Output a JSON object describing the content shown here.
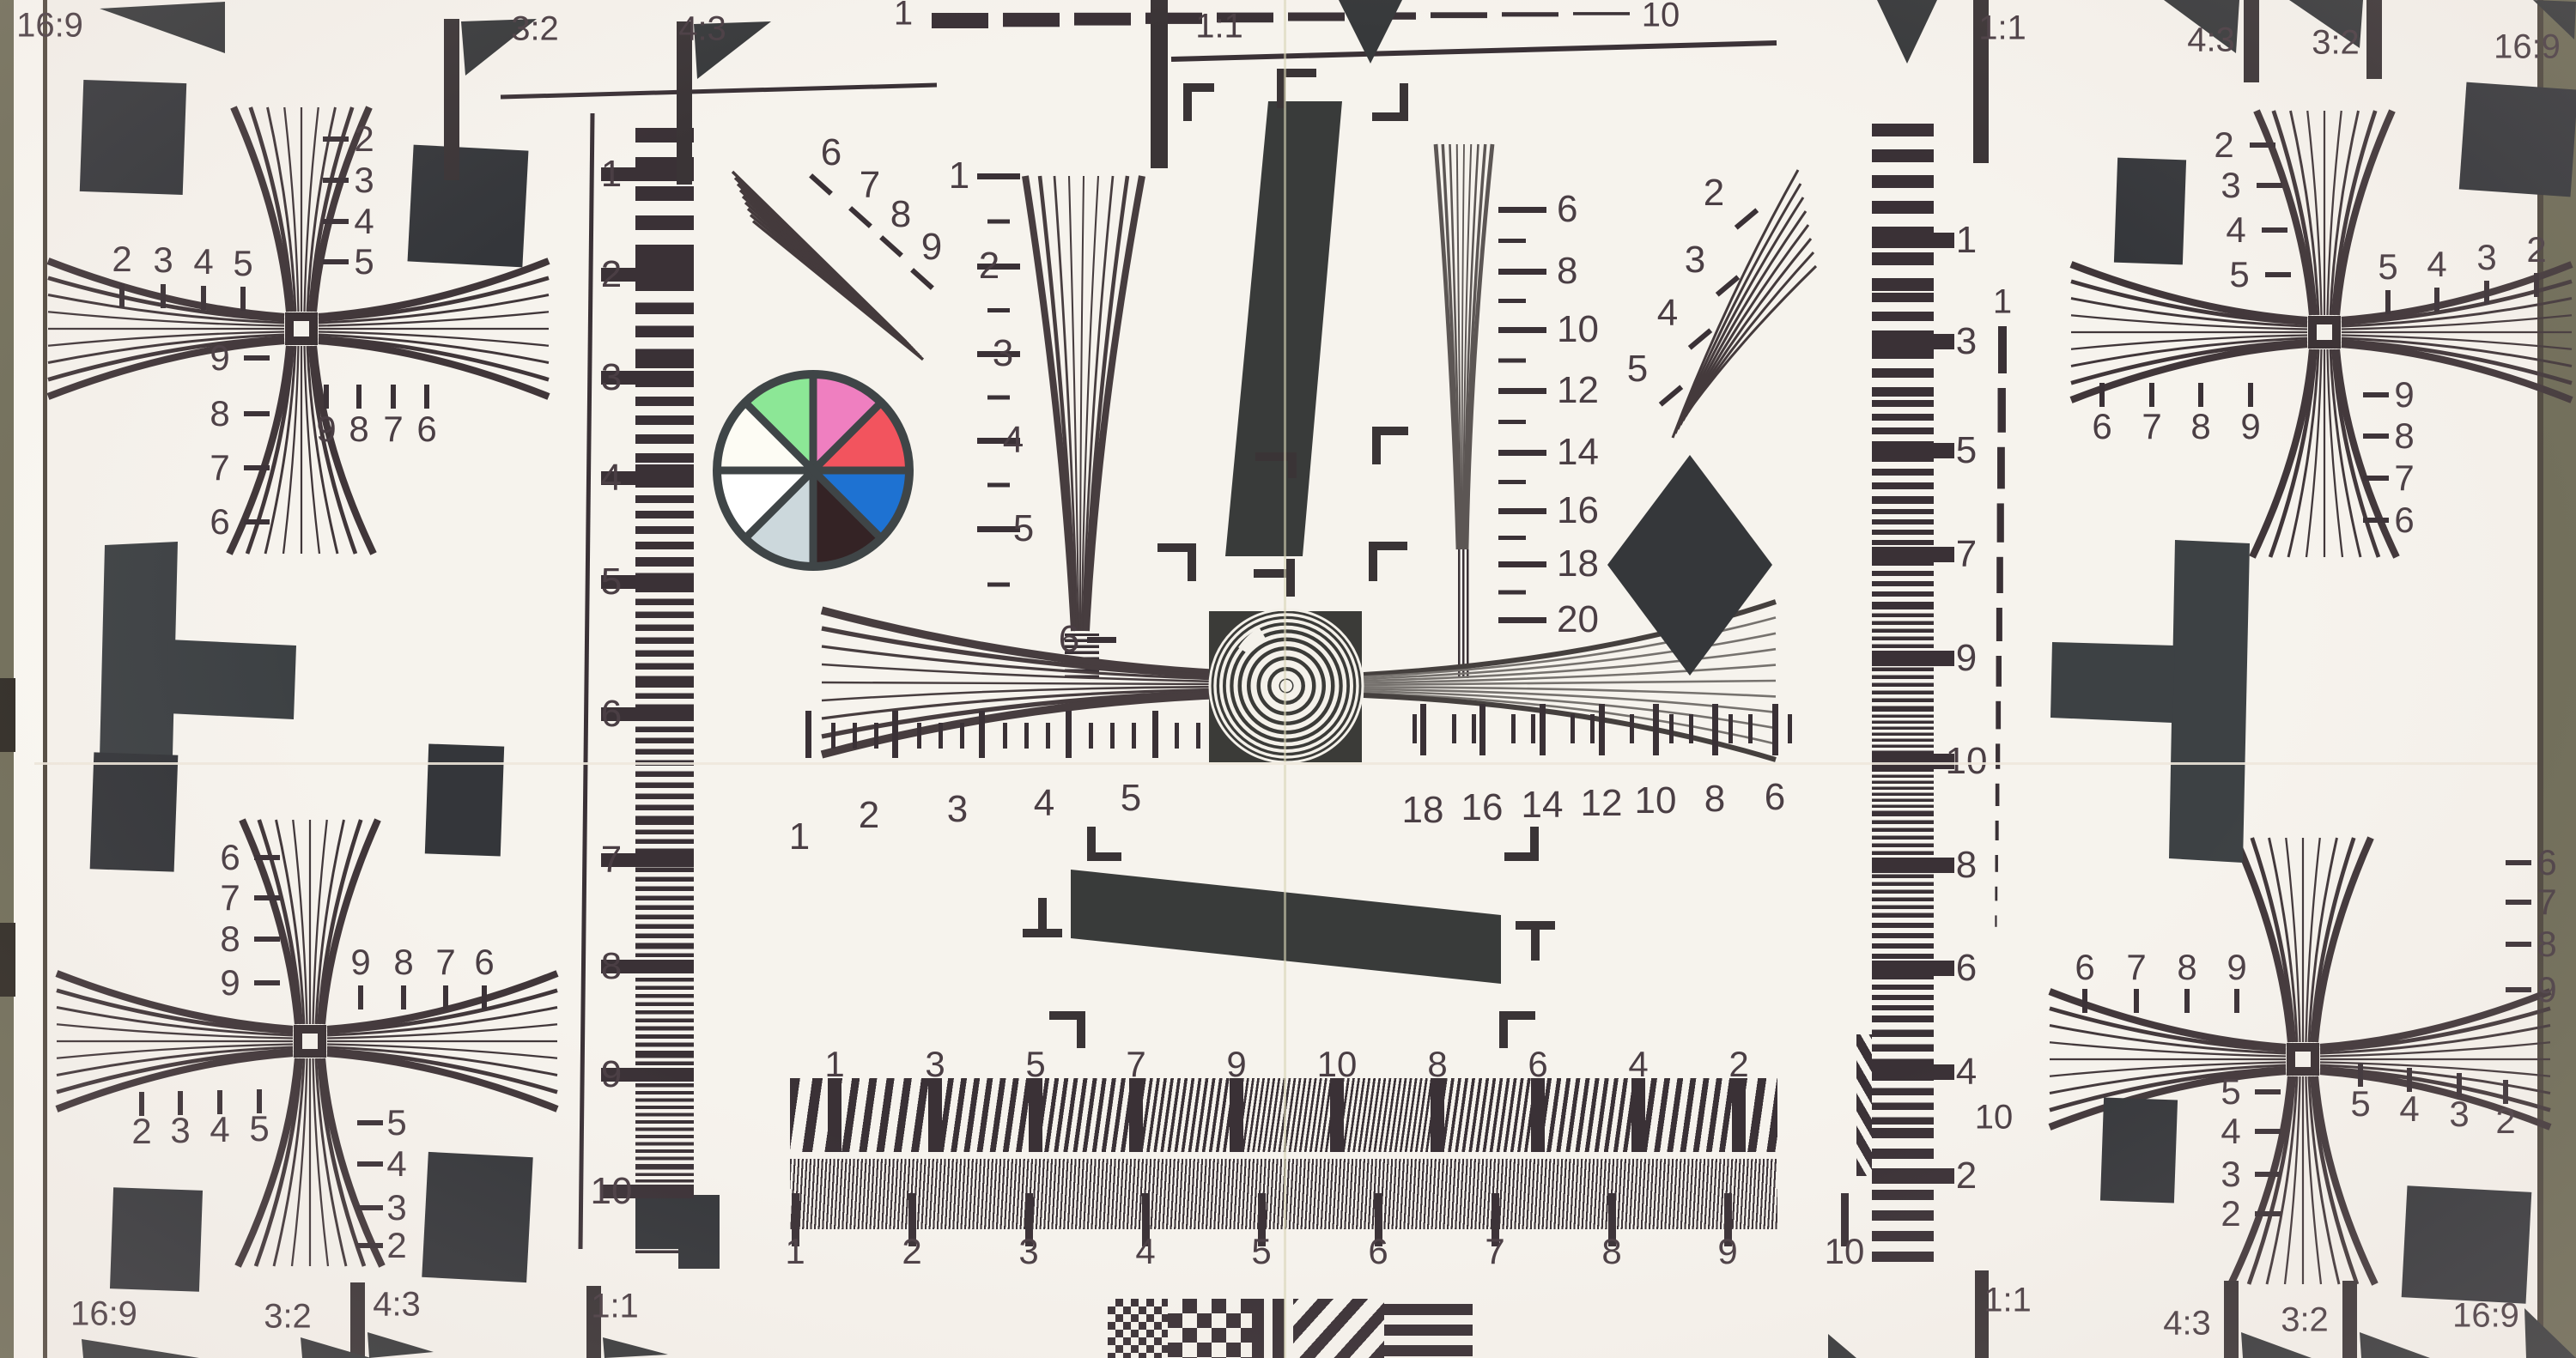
{
  "chart_title": "ISO 12233 resolution test chart (photograph)",
  "corner_labels": {
    "top": [
      "16:9",
      "3:2",
      "4:3",
      "1:1",
      "1:1",
      "4:3",
      "3:2",
      "16:9"
    ],
    "bottom": [
      "16:9",
      "3:2",
      "4:3",
      "1:1",
      "1:1",
      "4:3",
      "3:2",
      "16:9"
    ]
  },
  "top_ruler": {
    "start": "1",
    "end": "10"
  },
  "right_dashed_scale": {
    "top": "1",
    "bottom": "10"
  },
  "left_scale": [
    "1",
    "2",
    "3",
    "4",
    "5",
    "6",
    "7",
    "8",
    "9",
    "10"
  ],
  "inner_left_scale": [
    "1",
    "2",
    "3",
    "4",
    "5",
    "6"
  ],
  "inner_right_scale": [
    "6",
    "8",
    "10",
    "12",
    "14",
    "16",
    "18",
    "20"
  ],
  "diagonal_wedge_numbers": [
    "6",
    "7",
    "8",
    "9"
  ],
  "top_right_fan_numbers": [
    "2",
    "3",
    "4",
    "5"
  ],
  "center_ruler_left": [
    "1",
    "2",
    "3",
    "4",
    "5"
  ],
  "center_ruler_right": [
    "18",
    "16",
    "14",
    "12",
    "10",
    "8",
    "6"
  ],
  "bottom_wedge_numbers": [
    "1",
    "3",
    "5",
    "7",
    "9",
    "10",
    "8",
    "6",
    "4",
    "2"
  ],
  "bottom_ruler": [
    "1",
    "2",
    "3",
    "4",
    "5",
    "6",
    "7",
    "8",
    "9",
    "10"
  ],
  "right_strip_numbers": [
    "1",
    "3",
    "5",
    "7",
    "9",
    "10",
    "8",
    "6",
    "4",
    "2"
  ],
  "stars": {
    "top_left": {
      "above_left": [
        "2",
        "3",
        "4",
        "5"
      ],
      "right_column": [
        "2",
        "3",
        "4",
        "5"
      ],
      "left_column": [
        "9",
        "8",
        "7",
        "6"
      ],
      "below_right": [
        "9",
        "8",
        "7",
        "6"
      ]
    },
    "bottom_left": {
      "left_column": [
        "6",
        "7",
        "8",
        "9"
      ],
      "above_right": [
        "9",
        "8",
        "7",
        "6"
      ],
      "below_left": [
        "2",
        "3",
        "4",
        "5"
      ],
      "right_column": [
        "5",
        "4",
        "3",
        "2"
      ]
    },
    "top_right": {
      "left_column": [
        "2",
        "3",
        "4",
        "5"
      ],
      "above_right": [
        "5",
        "4",
        "3",
        "2"
      ],
      "below_left": [
        "6",
        "7",
        "8",
        "9"
      ],
      "right_column": [
        "9",
        "8",
        "7",
        "6"
      ]
    },
    "bottom_right": {
      "above_left": [
        "6",
        "7",
        "8",
        "9"
      ],
      "right_column": [
        "6",
        "7",
        "8",
        "9"
      ],
      "left_column": [
        "5",
        "4",
        "3",
        "2"
      ],
      "below_right": [
        "5",
        "4",
        "3",
        "2"
      ]
    }
  },
  "color_wheel": {
    "segments": [
      {
        "name": "pink",
        "color": "#ef7fc0"
      },
      {
        "name": "red",
        "color": "#f2545e"
      },
      {
        "name": "blue",
        "color": "#1e72d2"
      },
      {
        "name": "black",
        "color": "#342325"
      },
      {
        "name": "light-gray",
        "color": "#ccd8dc"
      },
      {
        "name": "white",
        "color": "#ffffff"
      },
      {
        "name": "warm-white",
        "color": "#fdfcf4"
      },
      {
        "name": "green",
        "color": "#8ce796"
      }
    ],
    "spoke_color": "#3f4547"
  },
  "palette": {
    "paper": "#f6f3ed",
    "ink": "#4a3e44",
    "shape_dark": "#37393b",
    "stripe_dark": "#3a3136",
    "photo_edge_olive": "#6f6d58",
    "gray_wedge": "#6e6a66"
  }
}
